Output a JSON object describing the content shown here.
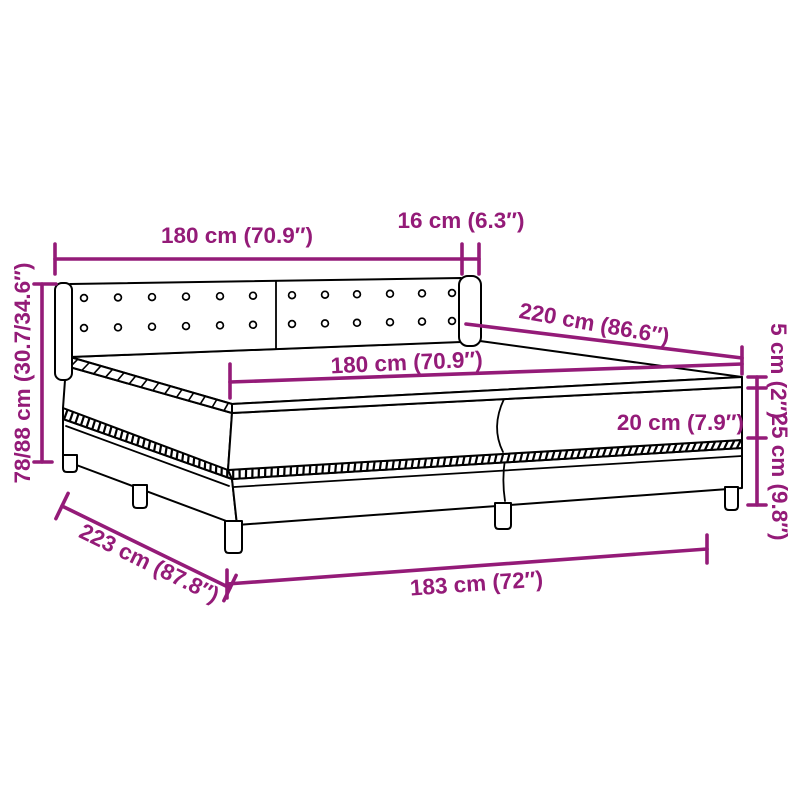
{
  "diagram": {
    "type": "product-dimension-diagram",
    "subject": "box spring bed with headboard, topper and legs",
    "accent_color": "#941B78",
    "outline_color": "#000000",
    "background_color": "#FFFFFF",
    "labels": {
      "headboard_width": "180 cm (70.9″)",
      "headboard_wing_depth": "16 cm (6.3″)",
      "bed_length": "220 cm (86.6″)",
      "mattress_width": "180 cm (70.9″)",
      "topper_height": "5 cm (2″)",
      "mattress_height": "20 cm (7.9″)",
      "base_height": "25 cm (9.8″)",
      "headboard_height": "78/88 cm (30.7/34.6″)",
      "base_length": "223 cm (87.8″)",
      "base_width": "183 cm (72″)"
    }
  }
}
